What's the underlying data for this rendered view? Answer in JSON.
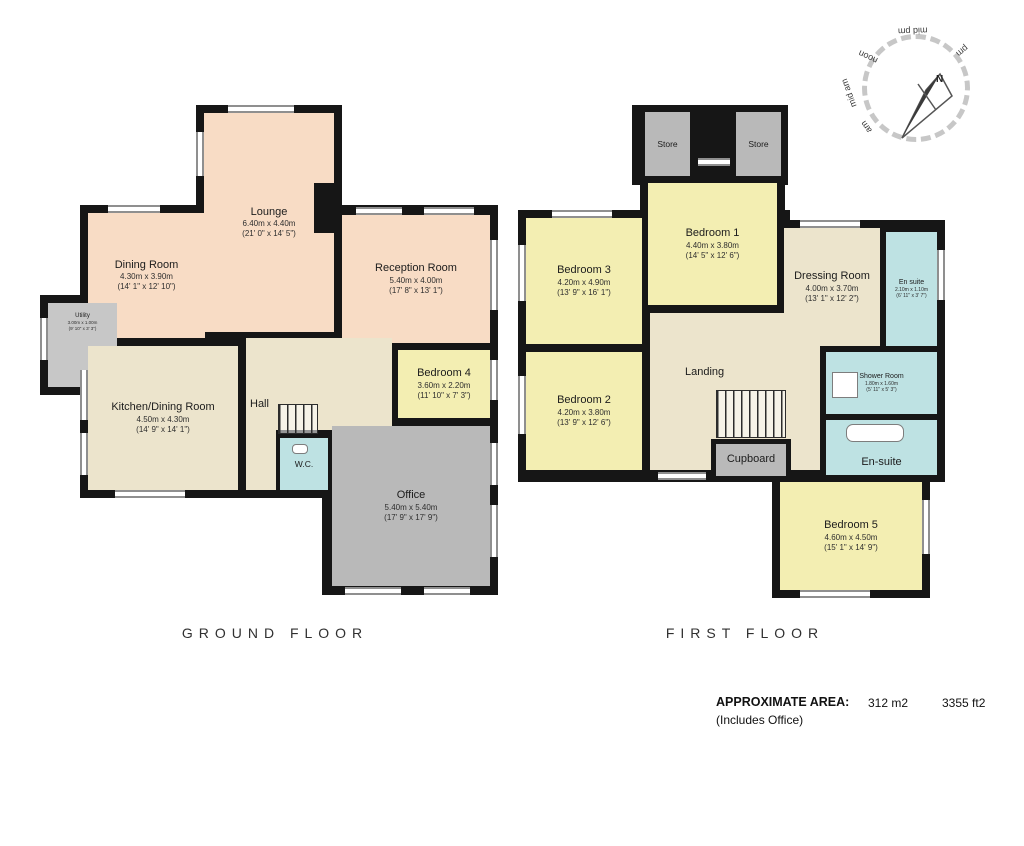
{
  "doc": {
    "type": "floorplan"
  },
  "floors": [
    {
      "label": "GROUND FLOOR",
      "rooms": [
        {
          "name": "Dining Room",
          "metric": "4.30m x 3.90m",
          "imperial": "(14' 1\" x 12' 10\")"
        },
        {
          "name": "Lounge",
          "metric": "6.40m x 4.40m",
          "imperial": "(21' 0\" x 14' 5\")"
        },
        {
          "name": "Reception Room",
          "metric": "5.40m x 4.00m",
          "imperial": "(17' 8\" x 13' 1\")"
        },
        {
          "name": "Utility",
          "metric": "3.00m x 1.00m",
          "imperial": "(9' 10\" x 3' 3\")"
        },
        {
          "name": "Kitchen/Dining Room",
          "metric": "4.50m x 4.30m",
          "imperial": "(14' 9\" x 14' 1\")"
        },
        {
          "name": "Hall"
        },
        {
          "name": "Bedroom 4",
          "metric": "3.60m x 2.20m",
          "imperial": "(11' 10\" x 7' 3\")"
        },
        {
          "name": "W.C."
        },
        {
          "name": "Office",
          "metric": "5.40m x 5.40m",
          "imperial": "(17' 9\" x 17' 9\")"
        }
      ]
    },
    {
      "label": "FIRST FLOOR",
      "rooms": [
        {
          "name": "Store"
        },
        {
          "name": "Store"
        },
        {
          "name": "Bedroom 1",
          "metric": "4.40m x 3.80m",
          "imperial": "(14' 5\" x 12' 6\")"
        },
        {
          "name": "Bedroom 3",
          "metric": "4.20m x 4.90m",
          "imperial": "(13' 9\" x 16' 1\")"
        },
        {
          "name": "Dressing Room",
          "metric": "4.00m x 3.70m",
          "imperial": "(13' 1\" x 12' 2\")"
        },
        {
          "name": "En suite",
          "metric": "2.10m x 1.10m",
          "imperial": "(6' 11\" x 3' 7\")"
        },
        {
          "name": "Bedroom 2",
          "metric": "4.20m x 3.80m",
          "imperial": "(13' 9\" x 12' 6\")"
        },
        {
          "name": "Landing"
        },
        {
          "name": "Cupboard"
        },
        {
          "name": "Shower Room",
          "metric": "1.80m x 1.60m",
          "imperial": "(5' 11\" x 5' 3\")"
        },
        {
          "name": "En-suite"
        },
        {
          "name": "Bedroom 5",
          "metric": "4.60m x 4.50m",
          "imperial": "(15' 1\" x 14' 9\")"
        }
      ]
    }
  ],
  "compass": {
    "north": "N",
    "labels": [
      "am",
      "mid am",
      "noon",
      "mid pm",
      "pm"
    ]
  },
  "footer": {
    "area_label": "APPROXIMATE AREA:",
    "area_m2": "312 m2",
    "area_ft2": "3355 ft2",
    "note": "(Includes Office)"
  },
  "colors": {
    "wall": "#161616",
    "reception_rooms": "#f8dcc5",
    "hall_landing": "#ece4cc",
    "bedrooms": "#f3eeb2",
    "bathrooms": "#bee2e3",
    "store_office": "#b9b9b9"
  }
}
